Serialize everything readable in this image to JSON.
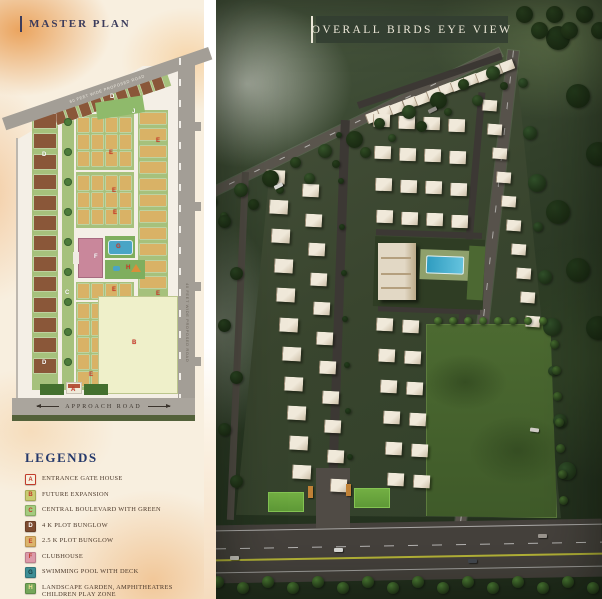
{
  "master_plan": {
    "title": "MASTER PLAN",
    "roads": {
      "top": "60 FEET WIDE PROPOSED ROAD",
      "right": "40 FEET WIDE PROPOSED ROAD",
      "bottom": "APPROACH ROAD"
    },
    "markers": [
      {
        "letter": "D",
        "x": 100,
        "y": 42,
        "color": "#ffffff"
      },
      {
        "letter": "J",
        "x": 122,
        "y": 57,
        "color": "#ffffff"
      },
      {
        "letter": "D",
        "x": 32,
        "y": 100,
        "color": "#ffffff"
      },
      {
        "letter": "E",
        "x": 146,
        "y": 86,
        "color": "#d03a2a"
      },
      {
        "letter": "E",
        "x": 99,
        "y": 98,
        "color": "#d03a2a"
      },
      {
        "letter": "E",
        "x": 102,
        "y": 136,
        "color": "#d03a2a"
      },
      {
        "letter": "E",
        "x": 103,
        "y": 158,
        "color": "#d03a2a"
      },
      {
        "letter": "F",
        "x": 84,
        "y": 202,
        "color": "#ffffff"
      },
      {
        "letter": "G",
        "x": 106,
        "y": 192,
        "color": "#d03a2a"
      },
      {
        "letter": "H",
        "x": 116,
        "y": 213,
        "color": "#d03a2a"
      },
      {
        "letter": "C",
        "x": 55,
        "y": 238,
        "color": "#ffffff"
      },
      {
        "letter": "E",
        "x": 102,
        "y": 235,
        "color": "#d03a2a"
      },
      {
        "letter": "E",
        "x": 146,
        "y": 239,
        "color": "#d03a2a"
      },
      {
        "letter": "B",
        "x": 122,
        "y": 288,
        "color": "#d03a2a"
      },
      {
        "letter": "D",
        "x": 32,
        "y": 308,
        "color": "#ffffff"
      },
      {
        "letter": "E",
        "x": 79,
        "y": 320,
        "color": "#d03a2a"
      },
      {
        "letter": "A",
        "x": 61,
        "y": 335,
        "color": "#d03a2a"
      }
    ]
  },
  "birds_eye": {
    "title": "OVERALL BIRDS EYE VIEW"
  },
  "legends": {
    "title": "LEGENDS",
    "items": [
      {
        "letter": "A",
        "label": "ENTRANCE GATE HOUSE",
        "box": "#f7efdd",
        "letter_color": "#c23b2a",
        "border": "#c23b2a"
      },
      {
        "letter": "B",
        "label": "FUTURE EXPANSION",
        "box": "#c9cc72",
        "letter_color": "#c23b2a",
        "border": "#a8ab55"
      },
      {
        "letter": "C",
        "label": "CENTRAL BOULEVARD WITH GREEN",
        "box": "#a5cb7f",
        "letter_color": "#c23b2a",
        "border": "#86ad61"
      },
      {
        "letter": "D",
        "label": "4 K PLOT BUNGLOW",
        "box": "#7d4c30",
        "letter_color": "#ffffff",
        "border": "#693d24"
      },
      {
        "letter": "E",
        "label": "2.5 K PLOT BUNGLOW",
        "box": "#dcb46c",
        "letter_color": "#c23b2a",
        "border": "#bd954e"
      },
      {
        "letter": "F",
        "label": "CLUBHOUSE",
        "box": "#dc9aa9",
        "letter_color": "#c23b2a",
        "border": "#bd7d8d"
      },
      {
        "letter": "G",
        "label": "SWIMMING POOL WITH DECK",
        "box": "#3e8e95",
        "letter_color": "#15393c",
        "border": "#2f747a"
      },
      {
        "letter": "H",
        "label": "LANDSCAPE GARDEN, AMPHITHEATRES CHILDREN PLAY ZONE",
        "box": "#74a65a",
        "letter_color": "#f2e196",
        "border": "#5c8c45"
      },
      {
        "letter": "J",
        "label": "SPORTS ZONES",
        "box": "#69a34e",
        "letter_color": "#ffffff",
        "border": "#54893b"
      }
    ]
  }
}
